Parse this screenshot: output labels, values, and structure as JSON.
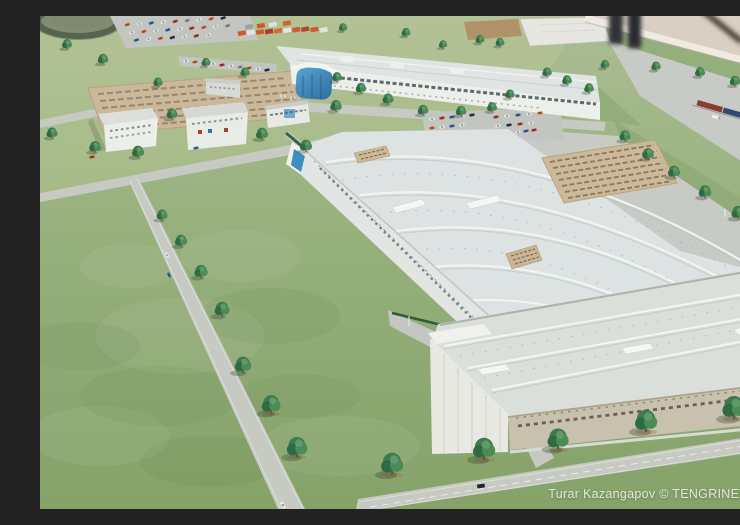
{
  "scene": {
    "alt": "Photograph of an architectural scale model of an industrial factory campus: two large light-roofed production halls, small white office buildings, parking lots filled with tiny cars, orange shipping containers, tree-lined roads, a freight train at the edge, tan information plaques, all on a green display table.",
    "watermark_credit": "Turar Kazangapov © TENGRINEWS",
    "landmarks": [
      "main-production-hall",
      "front-warehouse",
      "top-factory-building",
      "office-buildings",
      "parking-lots",
      "shipping-containers",
      "freight-train",
      "information-plaques",
      "tree-lined-roads",
      "test-track"
    ]
  },
  "palette": {
    "grass": "#93ad7a",
    "road": "#c7c9c3",
    "hall_roof": "#dce3e2",
    "warehouse_wall": "#c8c1ad",
    "plaque_tan": "#cdb999",
    "tree_green": "#3e7a4e",
    "accent_blue": "#3e8ec2",
    "container_orange": "#cf5a2c",
    "backdrop_beige": "#d9d0c3"
  }
}
